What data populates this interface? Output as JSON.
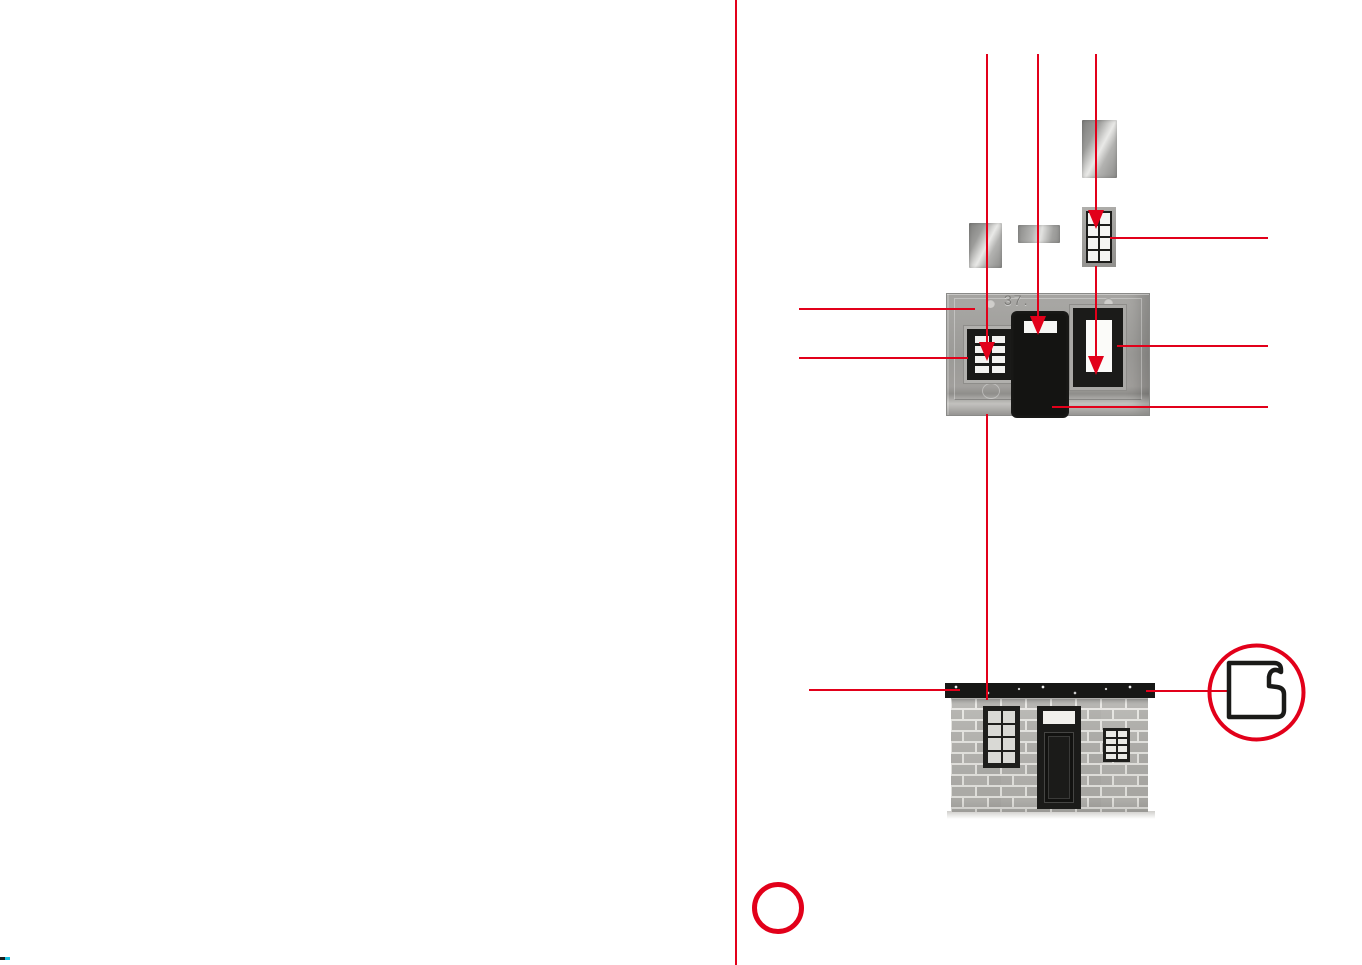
{
  "page": {
    "kind": "model-kit-assembly-instruction-sheet",
    "background": "#ffffff"
  },
  "colors": {
    "accent_red": "#e2001a",
    "registration_cyan": "#16bfdf",
    "part_dark": "#171715",
    "photo_grey": "#9c9b98"
  },
  "diagram": {
    "wall_part_number": "37.",
    "parts": {
      "glazing_small": "glazing-pane-small",
      "glazing_strip": "glazing-pane-strip",
      "glazing_large": "glazing-pane-large",
      "window_frame": "window-frame-part",
      "wall_back": "wall-part-back-view",
      "door": "door-part",
      "assembled": "assembled-building-photo"
    }
  },
  "icons": {
    "roof_profile": "roof-moulding-profile-icon"
  },
  "page_marker": {
    "label": ""
  }
}
